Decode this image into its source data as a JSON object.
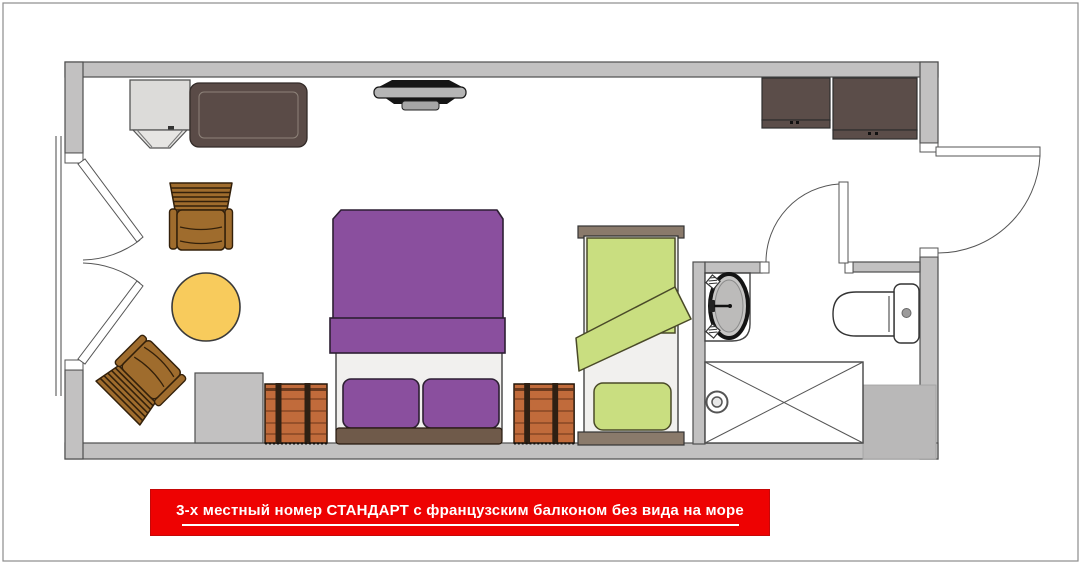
{
  "page": {
    "background": "#ffffff",
    "border_color": "#8c8c8c"
  },
  "banner": {
    "label": "3-х местный номер СТАНДАРТ с французским балконом без вида на море",
    "background": "#ee0202",
    "text_color": "#ffffff"
  },
  "colors": {
    "wall": "#c2c1c1",
    "wall_outline": "#4e4e4e",
    "column": "#c6c5c5",
    "shaft": "#b9b8b8",
    "double_bed": "#8a4f9e",
    "double_bed_outline": "#2d1f33",
    "single_bed": "#c9de80",
    "single_bed_outline": "#4a4a28",
    "mattress": "#f1f0ee",
    "headboard_double": "#6f5a4a",
    "board_single": "#8a7a6b",
    "chair": "#9f6c2d",
    "chair_dark": "#4a3008",
    "table": "#f8cb5c",
    "chest": "#c16b3b",
    "chest_line": "#7e4120",
    "chest_strap": "#2f2013",
    "wardrobe": "#5b4d49",
    "console": "#5a4b47",
    "cabinet": "#dcdbd9",
    "tv_black": "#151515",
    "tv_screen": "#b5b5b5",
    "fixture_white": "#ffffff",
    "sink_basin": "#c6c5c4",
    "door_leaf": "#ffffff"
  }
}
